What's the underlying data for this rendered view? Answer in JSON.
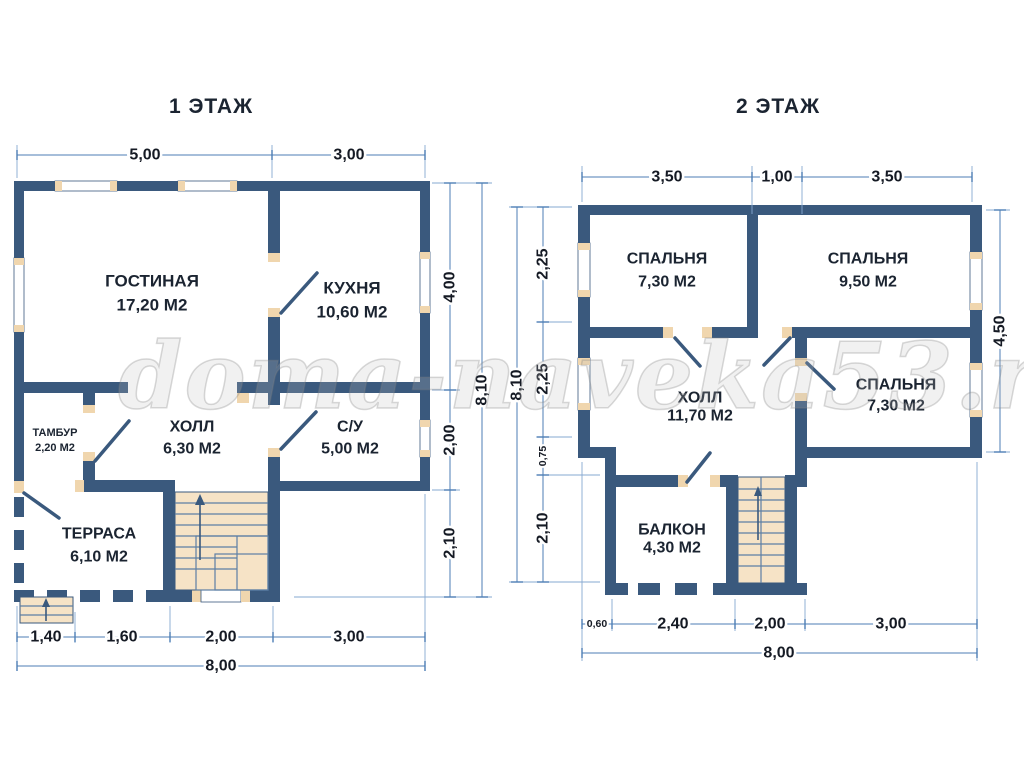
{
  "watermark": "doma-naveka53.ru",
  "colors": {
    "wall": "#3a597d",
    "tan": "#f0d6ae",
    "stair": "#f6e3c6",
    "tread": "#5c7fa5",
    "dim": "#4d7eb5",
    "dimlight": "#86a9d2",
    "ink": "#1b2431"
  },
  "plan1": {
    "title": "1 ЭТАЖ",
    "rooms": {
      "gostinaya": {
        "name": "ГОСТИНАЯ",
        "area": "17,20 М2"
      },
      "kuhnya": {
        "name": "КУХНЯ",
        "area": "10,60 М2"
      },
      "tambur": {
        "name": "ТАМБУР",
        "area": "2,20 М2"
      },
      "holl": {
        "name": "ХОЛЛ",
        "area": "6,30 М2"
      },
      "su": {
        "name": "С/У",
        "area": "5,00 М2"
      },
      "terrasa": {
        "name": "ТЕРРАСА",
        "area": "6,10 М2"
      }
    },
    "dims": {
      "top": [
        "5,00",
        "3,00"
      ],
      "right": [
        "4,00",
        "2,00",
        "2,10"
      ],
      "right_total": "8,10",
      "bottom": [
        "1,40",
        "1,60",
        "2,00",
        "3,00"
      ],
      "bottom_total": "8,00"
    }
  },
  "plan2": {
    "title": "2 ЭТАЖ",
    "rooms": {
      "spalnya1": {
        "name": "СПАЛЬНЯ",
        "area": "7,30 М2"
      },
      "spalnya2": {
        "name": "СПАЛЬНЯ",
        "area": "9,50 М2"
      },
      "spalnya3": {
        "name": "СПАЛЬНЯ",
        "area": "7,30 М2"
      },
      "holl": {
        "name": "ХОЛЛ",
        "area": "11,70 М2"
      },
      "balkon": {
        "name": "БАЛКОН",
        "area": "4,30 М2"
      }
    },
    "dims": {
      "top": [
        "3,50",
        "1,00",
        "3,50"
      ],
      "left": [
        "2,25",
        "2,25",
        "0,75",
        "2,10"
      ],
      "left_total": "8,10",
      "right": [
        "4,50"
      ],
      "bottom": [
        "0,60",
        "2,40",
        "2,00",
        "3,00"
      ],
      "bottom_total": "8,00"
    }
  }
}
